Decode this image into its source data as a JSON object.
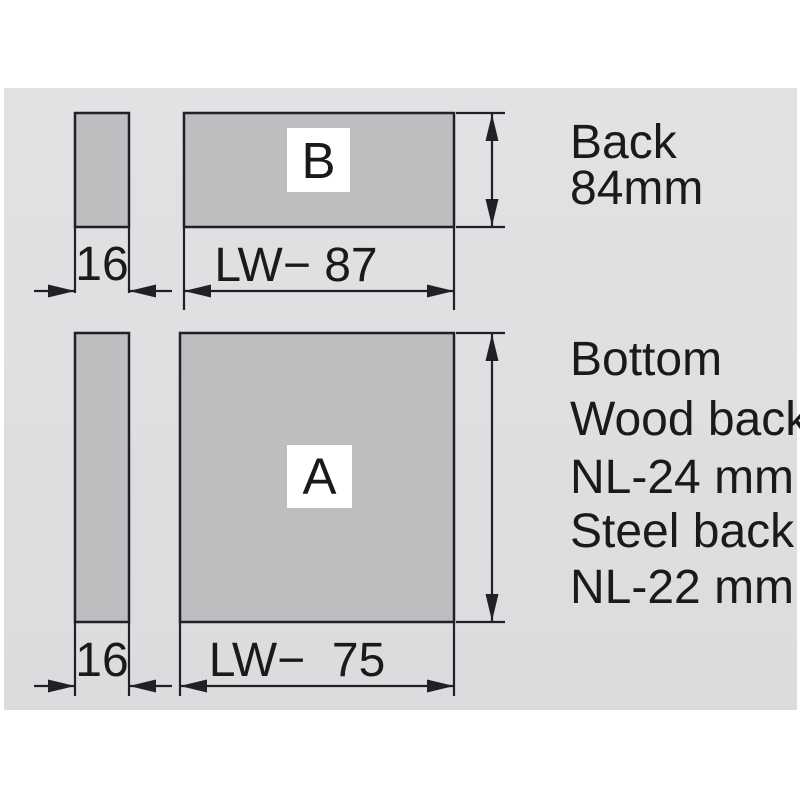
{
  "colors": {
    "page_bg": "#ffffff",
    "canvas_bg": "#dcdfe1",
    "panel_fill": "#bcbec0",
    "line": "#202124",
    "text": "#1a1a1a",
    "label_box_bg": "#ffffff"
  },
  "top_section": {
    "panel_label": "B",
    "spacer_thickness": "16",
    "width_dim": "LW− 87",
    "height_note_line1": "Back",
    "height_note_line2": "84mm"
  },
  "bottom_section": {
    "panel_label": "A",
    "spacer_thickness": "16",
    "width_dim": "LW−  75",
    "notes": [
      "Bottom",
      "Wood back",
      "NL-24 mm",
      "Steel back",
      "NL-22 mm"
    ]
  }
}
